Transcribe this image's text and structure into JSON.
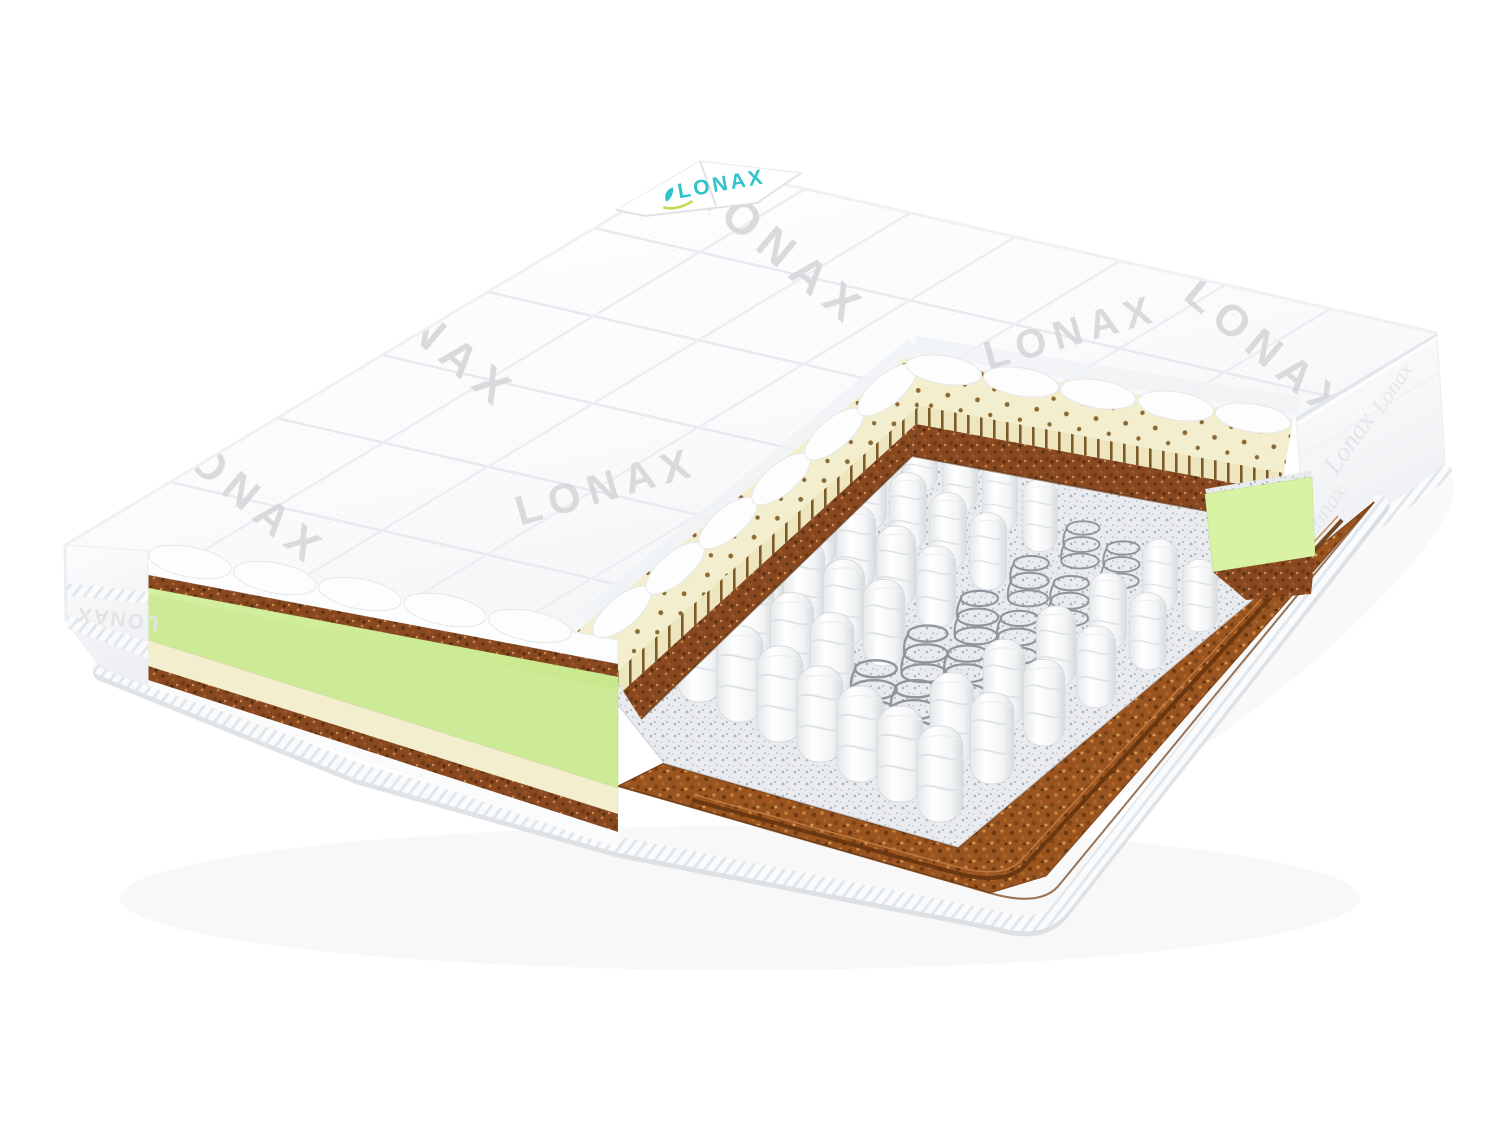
{
  "scene": {
    "background": "#ffffff",
    "subject": "mattress cutaway product photo"
  },
  "brand": {
    "tag_label": "LONAX",
    "fabric_watermark": "LONAX",
    "side_band_label": "LONAX",
    "side_script_label": "Lonax"
  },
  "colors": {
    "logo_teal": "#2fc3ca",
    "logo_leaf": "#c3d94e",
    "watermark_gray": "#d5d6d9",
    "cover_white": "#fdfdfe",
    "latex_cream": "#f3eecd",
    "latex_cut": "#ece5bd",
    "coir_brown": "#884920",
    "bottom_coir": "#99541f",
    "felt_gray": "#e9ebef",
    "foam_green": "#cdeb97",
    "foam_green_bright": "#d8f3a4",
    "spring_fabric": "#f4f6f7",
    "spring_metal": "#8f959b"
  }
}
